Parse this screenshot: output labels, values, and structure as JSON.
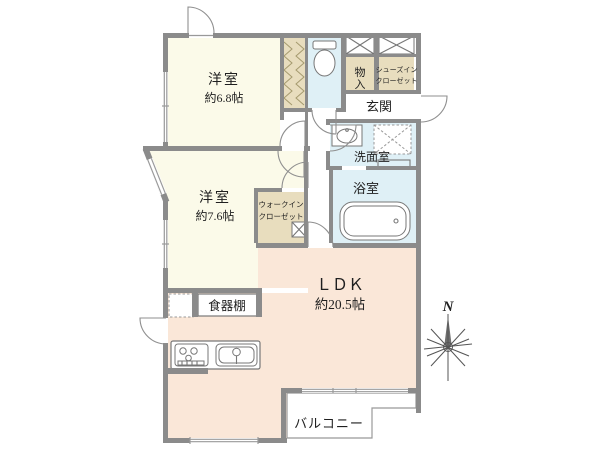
{
  "colors": {
    "wall": "#8b8b8b",
    "ivory": "#fbfae9",
    "peach": "#fae7d8",
    "blue": "#dff0f6",
    "tan": "#e8ddbe",
    "line": "#777777",
    "thin": "#999999",
    "text": "#1f1f1f",
    "hatch": "#a59a6e"
  },
  "rooms": {
    "bedroom1": {
      "label": "洋室",
      "size": "約6.8帖"
    },
    "bedroom2": {
      "label": "洋室",
      "size": "約7.6帖"
    },
    "ldk": {
      "label": "ＬＤＫ",
      "size": "約20.5帖"
    },
    "entrance": {
      "label": "玄関"
    },
    "washroom": {
      "label": "洗面室"
    },
    "bathroom": {
      "label": "浴室"
    },
    "storage": {
      "line1": "物",
      "line2": "入"
    },
    "shoe_closet": {
      "line1": "シューズイン",
      "line2": "クローゼット"
    },
    "walk_in_closet": {
      "line1": "ウォークイン",
      "line2": "クローゼット"
    },
    "cupboard": {
      "label": "食器棚"
    },
    "balcony": {
      "label": "バルコニー"
    }
  },
  "compass": {
    "north": "N"
  }
}
